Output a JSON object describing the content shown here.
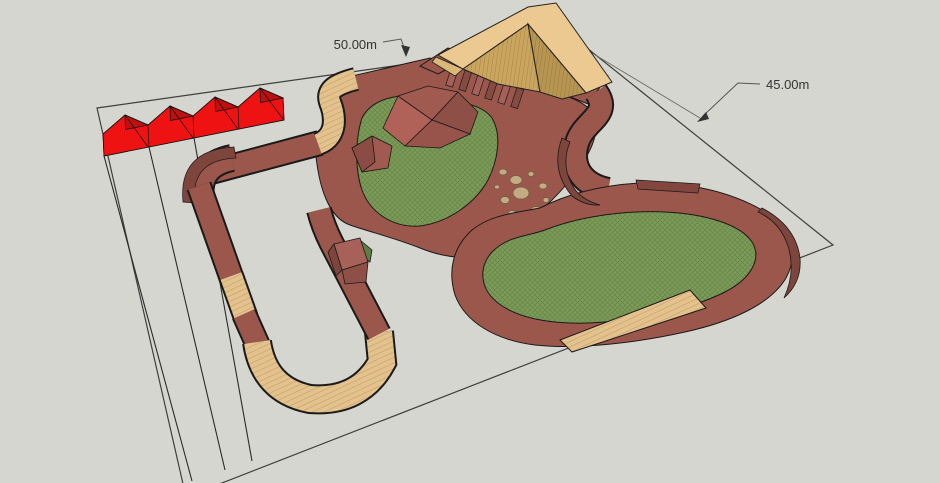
{
  "viewport": {
    "type": "3d-model-view",
    "description": "Pump track site plan, isometric 3D render"
  },
  "dimensions": {
    "width_label": "50.00m",
    "depth_label": "45.00m"
  },
  "palette": {
    "background": "#d6d6d0",
    "plot_line": "#3f3f3f",
    "track_surface": "#9c574d",
    "track_shadow": "#7e453d",
    "berm_wall": "#7e453d",
    "wood_tan": "#e3c28d",
    "wood_stripe": "#c9a06a",
    "wall_ride_top": "#ecc990",
    "wall_ride_face": "#c9a55f",
    "grass_green": "#7d9c58",
    "grass_hatch": "#69884b",
    "tent_red": "#ee1212",
    "tent_red_dark": "#c00f0f",
    "rock_tan": "#c3ab82",
    "annotation_text": "#333333"
  },
  "scene_objects": [
    "canopy-tent-row",
    "wall-ride-chevron",
    "pump-track-circuit",
    "grass-infield-left",
    "grass-infield-right",
    "rock-garden",
    "roller-section",
    "jump-box",
    "berm-corners",
    "plot-boundary"
  ]
}
